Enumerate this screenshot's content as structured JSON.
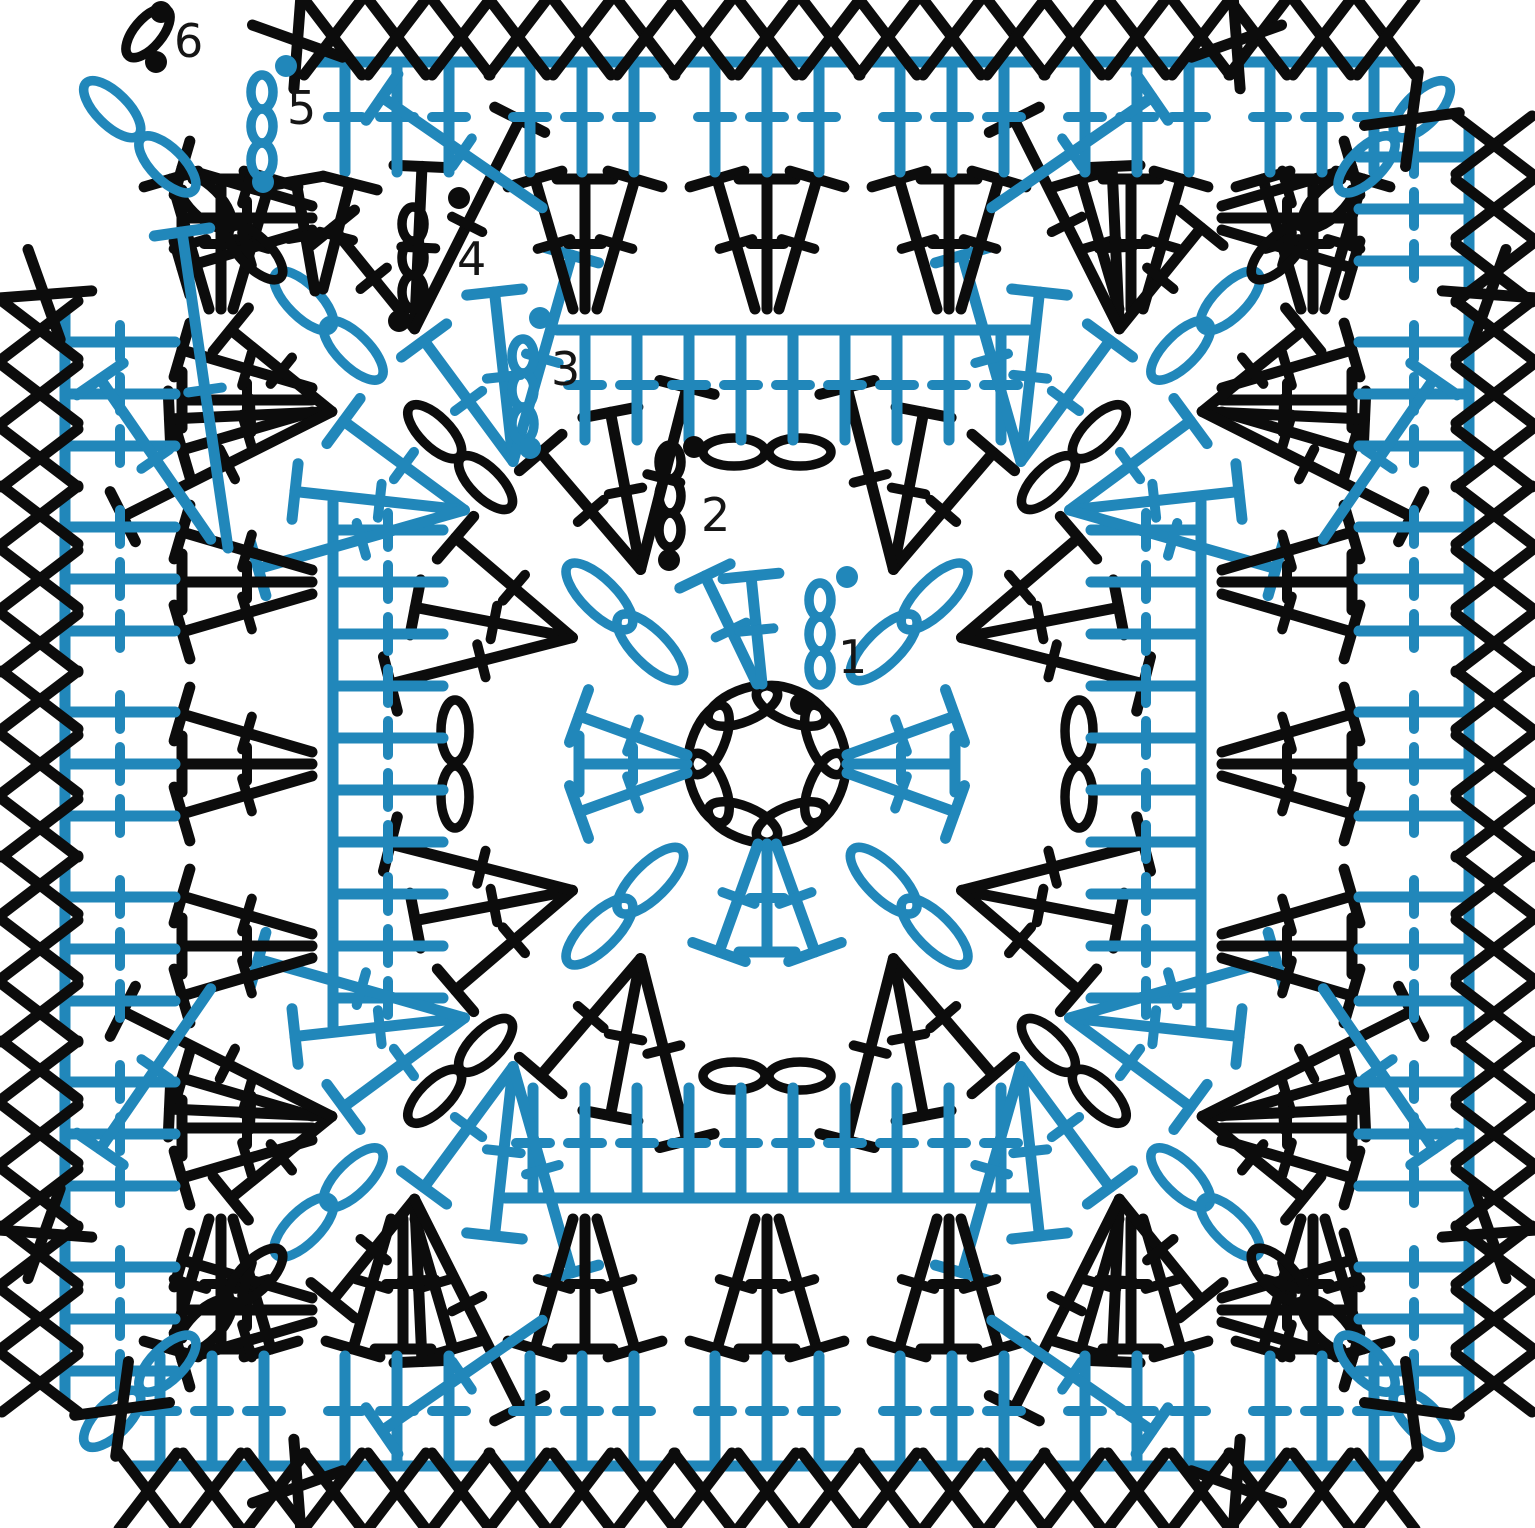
{
  "figure": {
    "title": "Granny square crochet chart, 6 rounds",
    "width": 1535,
    "height": 1528,
    "cx": 767,
    "cy": 764,
    "background": "#ffffff"
  },
  "palette": {
    "black": "#0c0c0c",
    "blue": "#2187ba"
  },
  "style": {
    "stem": 11,
    "oval": 9.5,
    "bar_half": 28,
    "tick_half": 17,
    "x_half_w": 29,
    "x_half_h": 38,
    "dot_r": 11,
    "label_size": 46,
    "label_color": "#151515"
  },
  "symbols": {
    "chain": "open-oval",
    "double_crochet": "T-bar-with-tick",
    "single_crochet": "X",
    "slip_stitch": "filled-dot"
  },
  "center_ring": {
    "count": 8,
    "r": 63,
    "len": 74,
    "wid": 32,
    "color": "black",
    "start_deg": 22.5
  },
  "round_labels": [
    {
      "text": "1",
      "x": 838,
      "y": 657
    },
    {
      "text": "2",
      "x": 701,
      "y": 515
    },
    {
      "text": "3",
      "x": 551,
      "y": 369
    },
    {
      "text": "4",
      "x": 457,
      "y": 259
    },
    {
      "text": "5",
      "x": 287,
      "y": 108
    },
    {
      "text": "6",
      "x": 174,
      "y": 41
    }
  ],
  "slip_dots": [
    {
      "x": 801,
      "y": 704,
      "color": "black"
    },
    {
      "x": 847,
      "y": 577,
      "color": "blue"
    },
    {
      "x": 694,
      "y": 447,
      "color": "black"
    },
    {
      "x": 669,
      "y": 560,
      "color": "black"
    },
    {
      "x": 540,
      "y": 318,
      "color": "blue"
    },
    {
      "x": 530,
      "y": 448,
      "color": "blue"
    },
    {
      "x": 459,
      "y": 198,
      "color": "black"
    },
    {
      "x": 399,
      "y": 321,
      "color": "black"
    },
    {
      "x": 286,
      "y": 66,
      "color": "blue"
    },
    {
      "x": 263,
      "y": 182,
      "color": "blue"
    },
    {
      "x": 161,
      "y": 12,
      "color": "black"
    },
    {
      "x": 156,
      "y": 62,
      "color": "black"
    }
  ],
  "start_chains": [
    {
      "round": 1,
      "x": 820,
      "ys": [
        600,
        634,
        668
      ],
      "color": "blue"
    },
    {
      "round": 2,
      "x": 670,
      "ys": [
        462,
        496,
        530
      ],
      "color": "black"
    },
    {
      "round": 3,
      "x": 523,
      "ys": [
        356,
        390,
        424
      ],
      "color": "blue"
    },
    {
      "round": 4,
      "x": 413,
      "ys": [
        224,
        258,
        292
      ],
      "color": "black"
    },
    {
      "round": 5,
      "x": 262,
      "ys": [
        92,
        126,
        160
      ],
      "color": "blue"
    }
  ],
  "start_chain_oval": {
    "len": 34,
    "wid": 22,
    "angle": 90
  },
  "finish_chain": {
    "x": 148,
    "y": 33,
    "angle": -50,
    "len": 60,
    "wid": 28,
    "color": "black"
  },
  "extra_stitches": [
    {
      "color": "black",
      "base": [
        315,
        291
      ],
      "tip": [
        296,
        181
      ]
    },
    {
      "color": "black",
      "base": [
        323,
        289
      ],
      "tip": [
        350,
        183
      ]
    },
    {
      "color": "blue",
      "base": [
        228,
        548
      ],
      "tip": [
        182,
        232
      ]
    }
  ],
  "rounds": [
    {
      "n": 1,
      "color": "blue",
      "type": "center_fans",
      "side_fans": {
        "sides": [
          1,
          2,
          3
        ],
        "tip_u": [
          -48,
          0,
          48
        ],
        "tip_r": 188,
        "base_u": [
          -9,
          0,
          9
        ],
        "base_r": 80
      },
      "start_side_fan": {
        "side": 0,
        "tip_u": [
          -62,
          -16
        ],
        "tip_r": 188,
        "base_u": [
          -10,
          -5
        ],
        "base_r": 80
      },
      "corner_chains": {
        "radii": [
          165,
          237
        ],
        "len": 88,
        "wid": 34
      }
    },
    {
      "n": 2,
      "color": "black",
      "type": "corner_shells",
      "corner_fans": {
        "tip_angles": [
          9,
          21,
          33
        ],
        "tip_r": 385,
        "base_angle": 12,
        "base_r": 232
      },
      "corner_chains": {
        "radii": [
          398,
          470
        ],
        "len": 70,
        "wid": 30
      },
      "side_chains": {
        "u": [
          -33,
          33
        ],
        "r": 312,
        "len": 62,
        "wid": 28
      }
    },
    {
      "n": 3,
      "color": "blue",
      "type": "dc_round",
      "sides": {
        "count": 10,
        "spacing": 52,
        "base_r": 324,
        "tip_r": 434,
        "skip": [
          [
            0,
            0
          ]
        ]
      },
      "corner_fans": {
        "tip_angles": [
          6,
          15,
          24
        ],
        "tip_r": 545,
        "base_angle": 5,
        "base_r": 395
      },
      "corner_chains": {
        "radii": [
          585,
          655
        ],
        "len": 78,
        "wid": 32
      }
    },
    {
      "n": 4,
      "color": "black",
      "type": "shell_row",
      "sides": {
        "centers_step": 182,
        "k_range": 3,
        "tip_du": [
          -50,
          0,
          50
        ],
        "tip_r": 585,
        "base_du": [
          -12,
          0,
          12
        ],
        "base_r": 455,
        "skip": [
          [
            0,
            -2
          ]
        ]
      },
      "corner_fans": {
        "tip_angles": [
          6,
          15,
          24
        ],
        "tip_r": 690,
        "base_angle": 6,
        "base_r": 560
      },
      "corner_chains": {
        "radii": [
          723,
          795
        ],
        "len": 70,
        "wid": 30
      }
    },
    {
      "n": 5,
      "color": "blue",
      "type": "dc_groups",
      "sides": {
        "centers_step": 185,
        "k_range": 3,
        "du": [
          -52,
          0,
          52
        ],
        "base_r": 592,
        "tip_r": 702,
        "skip": [
          [
            0,
            -3
          ],
          [
            3,
            3
          ]
        ]
      },
      "corner_slant_dc": {
        "tip_angle": 15,
        "tip_r": 770,
        "base_angle": 23,
        "base_r": 600
      },
      "corner_chains": {
        "radii": [
          848,
          926
        ],
        "len": 74,
        "wid": 32
      }
    },
    {
      "n": 6,
      "color": "black",
      "type": "sc_border",
      "sides": {
        "centers_step": 185,
        "k_range": 3,
        "du": [
          -64,
          0,
          64
        ],
        "r": 727,
        "skip": [
          [
            0,
            -3
          ],
          [
            3,
            3
          ]
        ]
      },
      "corner_xs": {
        "arc": [
          {
            "da": -12,
            "r": 862
          },
          {
            "da": 0,
            "r": 912
          },
          {
            "da": 12,
            "r": 862
          }
        ],
        "skip_middle_corner": 3
      }
    }
  ]
}
